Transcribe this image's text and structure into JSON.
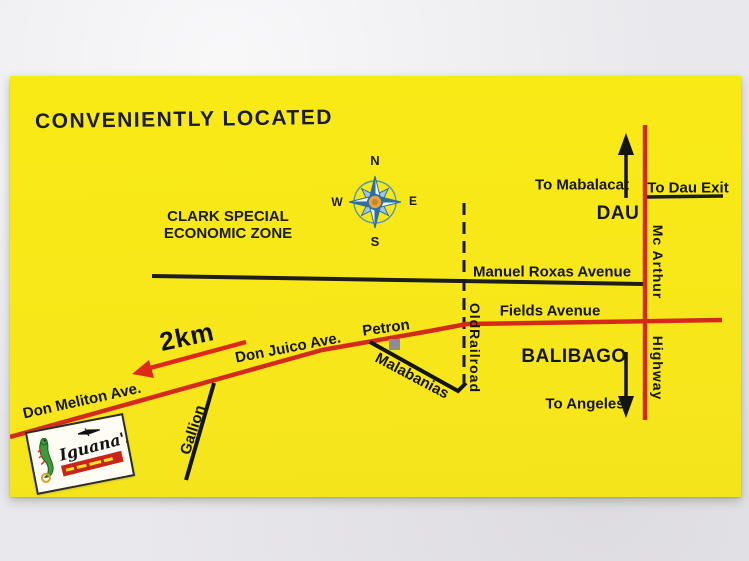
{
  "title": "CONVENIENTLY LOCATED",
  "compass": {
    "n": "N",
    "s": "S",
    "e": "E",
    "w": "W"
  },
  "zone": {
    "line1": "CLARK SPECIAL",
    "line2": "ECONOMIC ZONE"
  },
  "places": {
    "dau": "DAU",
    "balibago": "BALIBAGO",
    "petron": "Petron"
  },
  "directions": {
    "to_mabalacat": "To Mabalacat",
    "to_dau_exit": "To Dau Exit",
    "to_angeles": "To Angeles",
    "distance": "2km"
  },
  "roads": {
    "manuel_roxas": "Manuel Roxas Avenue",
    "fields": "Fields Avenue",
    "don_juico": "Don Juico Ave.",
    "don_meliton": "Don Meliton Ave.",
    "gallion": "Gallion",
    "malabanias": "Malabanias",
    "mcarthur_word1": "Mc Arthur",
    "mcarthur_word2": "Highway",
    "railroad_word1": "Old",
    "railroad_word2": "Railroad"
  },
  "logo": {
    "name": "Iguana's"
  },
  "colors": {
    "card_yellow": "#f9ea16",
    "road_red": "#d32a1c",
    "line_black": "#1d1d1d",
    "title_navy": "#1b1b33",
    "petron_gray": "#8d8d99",
    "logo_green": "#3f9a3a",
    "logo_banner_red": "#c9231a"
  }
}
